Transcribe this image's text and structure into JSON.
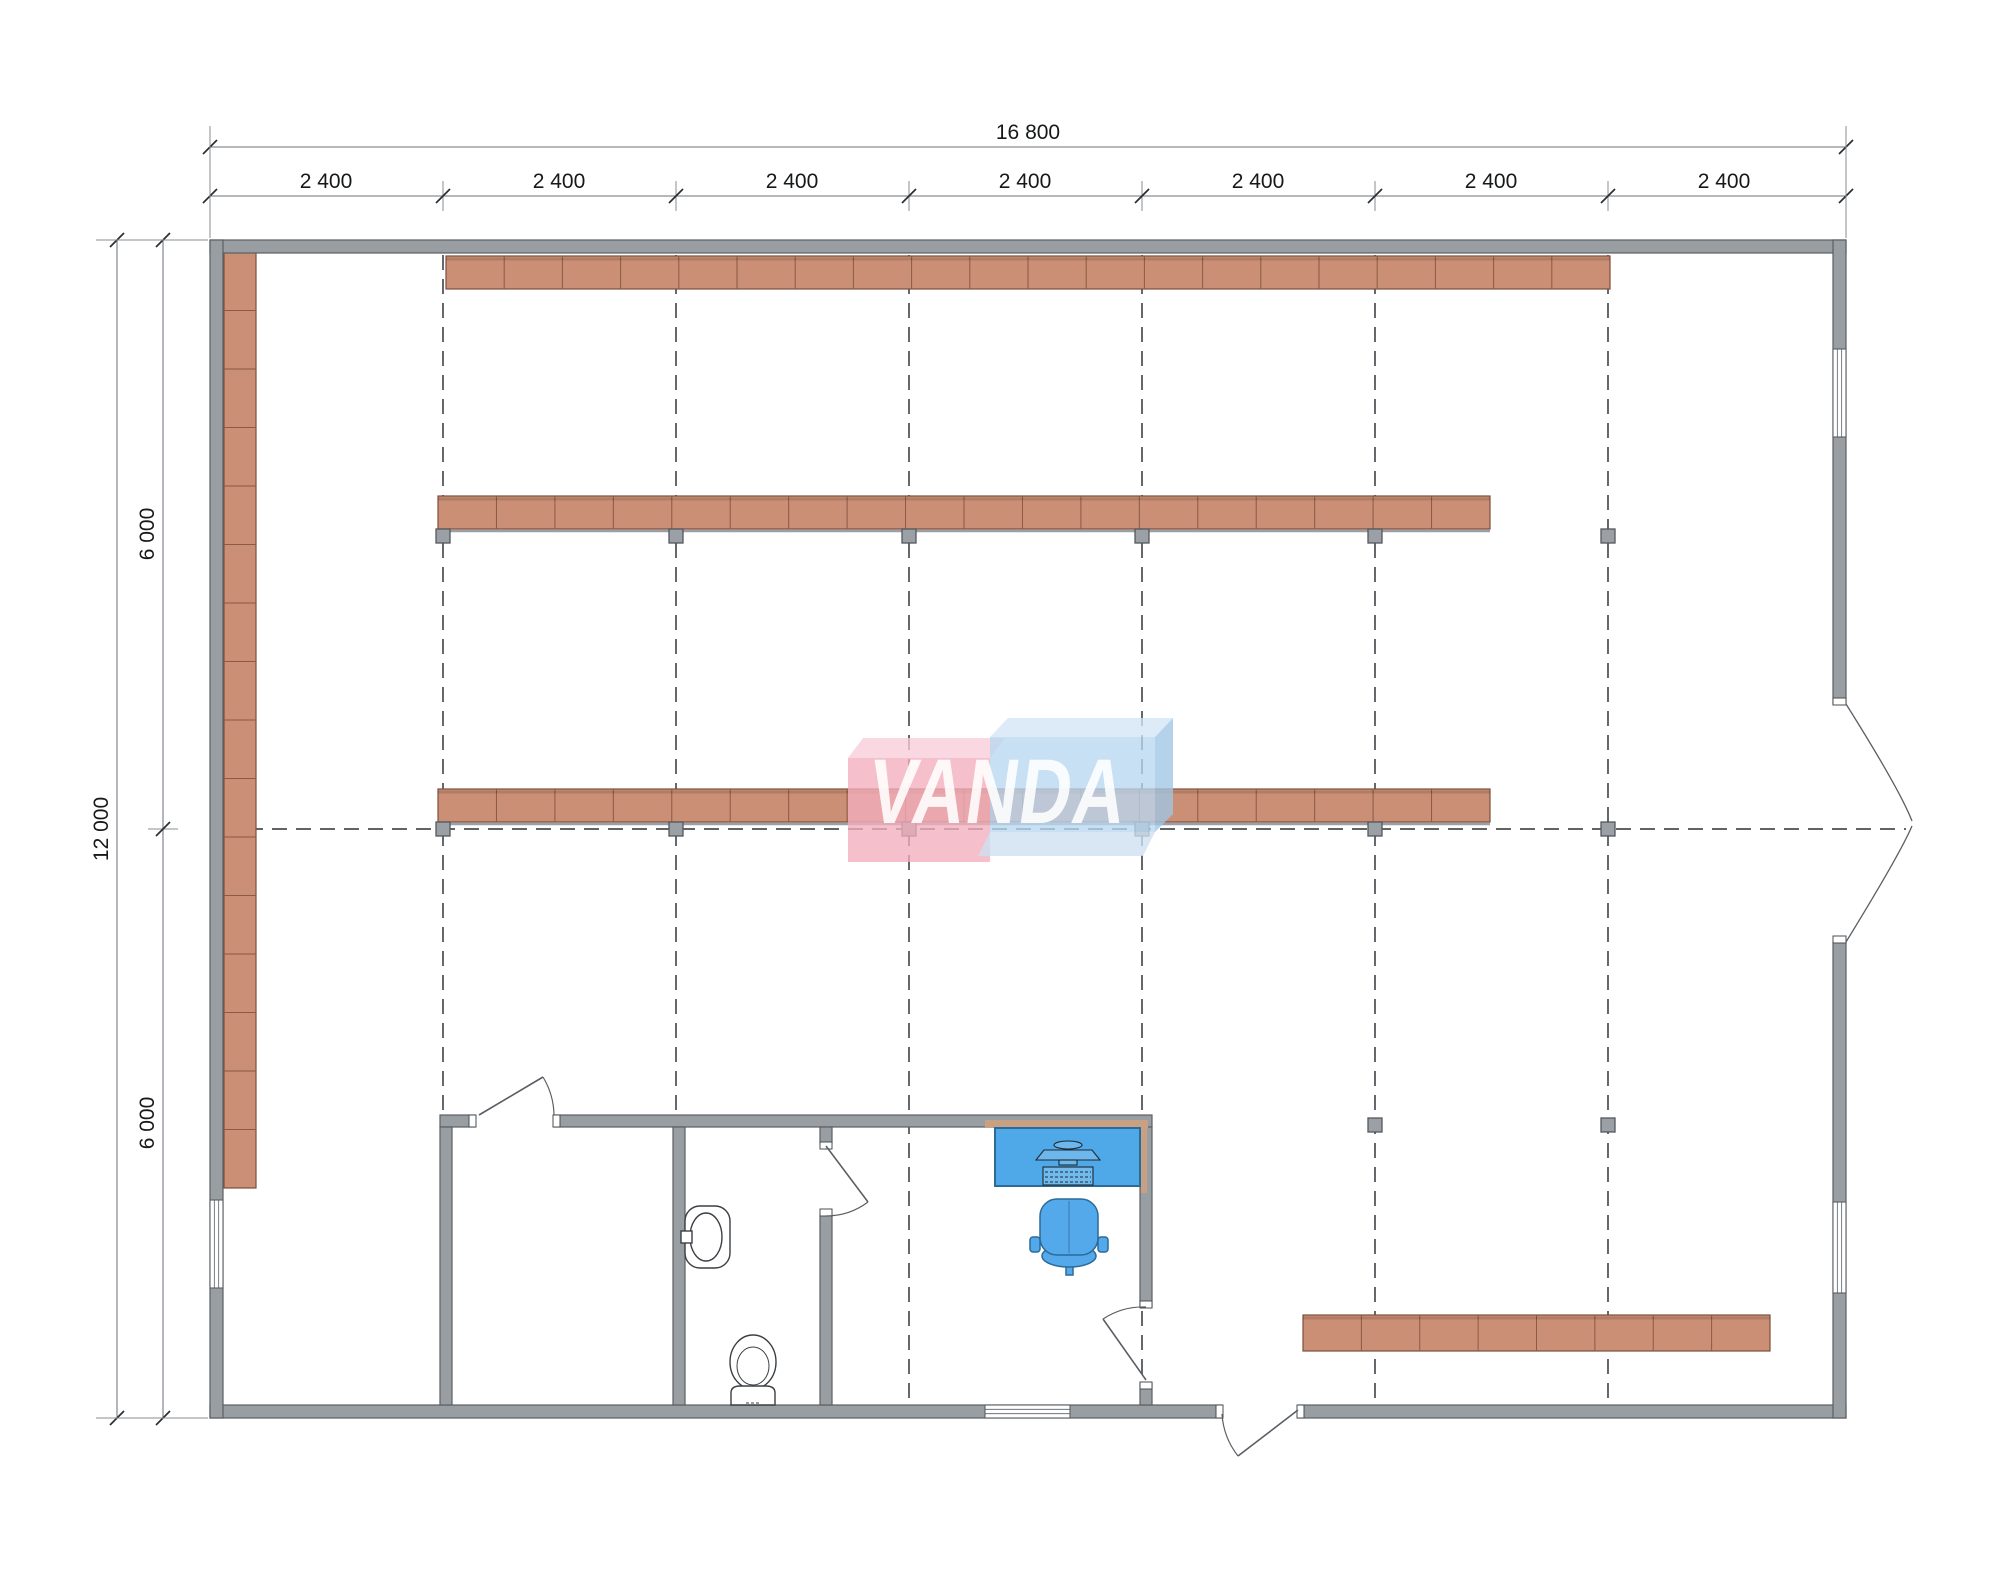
{
  "drawing": {
    "type": "retail-floor-plan",
    "logo_text": "VANDA",
    "dimensions": {
      "total_width": "16 800",
      "top_segments": [
        "2 400",
        "2 400",
        "2 400",
        "2 400",
        "2 400",
        "2 400",
        "2 400"
      ],
      "total_height": "12 000",
      "left_segments": [
        "6 000",
        "6 000"
      ]
    },
    "colors": {
      "wall_fill": "#999ea3",
      "wall_stroke": "#5a5f64",
      "shelf_fill": "#cb8f75",
      "shelf_stroke": "#7c4f3c",
      "shelf_divider": "#8a5a44",
      "marker_fill": "#9aa0a6",
      "marker_stroke": "#54585c",
      "desk_fill": "#4fa8e8",
      "chair_fill": "#54a9ea",
      "furniture_stroke": "#2a6b97",
      "fixture_stroke": "#3a3f44",
      "grid_color": "#4a4e52",
      "dim_line_color": "#8a8f94",
      "tick_color": "#2a2d30",
      "counter_tan": "#c8a184",
      "logo_pink": "#f2aebc",
      "logo_pink_lid": "#f8cdd8",
      "logo_blue": "#b9d7ef",
      "logo_blue_lid": "#d3e6f6",
      "logo_blue_side": "#9fc6e4",
      "logo_letter": "#ffffff"
    },
    "geometry": {
      "grid": {
        "verticals": [
          443,
          676,
          909,
          1142,
          1375,
          1608
        ],
        "v_y1": 255,
        "v_y2": 1405,
        "horizontal": {
          "y": 829,
          "x1": 224,
          "x2": 1906
        }
      },
      "walls": [
        {
          "x": 210,
          "y": 240,
          "w": 1636,
          "h": 13,
          "name": "wall-top"
        },
        {
          "x": 210,
          "y": 1405,
          "w": 1012,
          "h": 13,
          "name": "wall-bottom-left"
        },
        {
          "x": 1298,
          "y": 1405,
          "w": 548,
          "h": 13,
          "name": "wall-bottom-right"
        },
        {
          "x": 210,
          "y": 240,
          "w": 13,
          "h": 1178,
          "name": "wall-left"
        },
        {
          "x": 1833,
          "y": 240,
          "w": 13,
          "h": 464,
          "name": "wall-right-upper"
        },
        {
          "x": 1833,
          "y": 942,
          "w": 13,
          "h": 476,
          "name": "wall-right-lower"
        },
        {
          "x": 440,
          "y": 1115,
          "w": 35,
          "h": 12,
          "name": "rooms-top-wall-a"
        },
        {
          "x": 554,
          "y": 1115,
          "w": 598,
          "h": 12,
          "name": "rooms-top-wall-b"
        },
        {
          "x": 440,
          "y": 1127,
          "w": 12,
          "h": 278,
          "name": "rooms-left-wall"
        },
        {
          "x": 673,
          "y": 1127,
          "w": 12,
          "h": 278,
          "name": "bathroom-left-wall"
        },
        {
          "x": 820,
          "y": 1127,
          "w": 12,
          "h": 16,
          "name": "bathroom-right-stub"
        },
        {
          "x": 820,
          "y": 1215,
          "w": 12,
          "h": 190,
          "name": "bathroom-right-wall"
        },
        {
          "x": 1140,
          "y": 1127,
          "w": 12,
          "h": 180,
          "name": "office-right-wall-upper"
        },
        {
          "x": 1140,
          "y": 1383,
          "w": 12,
          "h": 22,
          "name": "office-right-wall-lower"
        }
      ],
      "shelves": [
        {
          "x": 224,
          "y": 252,
          "w": 32,
          "h": 936,
          "segs": 16,
          "dir": "v",
          "name": "shelf-row-left"
        },
        {
          "x": 446,
          "y": 256,
          "w": 1164,
          "h": 33,
          "segs": 20,
          "dir": "h",
          "name": "shelf-row-1"
        },
        {
          "x": 438,
          "y": 496,
          "w": 1052,
          "h": 33,
          "segs": 18,
          "dir": "h",
          "base": true,
          "name": "shelf-row-2"
        },
        {
          "x": 438,
          "y": 789,
          "w": 1052,
          "h": 33,
          "segs": 18,
          "dir": "h",
          "base": true,
          "name": "shelf-row-3"
        },
        {
          "x": 1303,
          "y": 1315,
          "w": 467,
          "h": 36,
          "segs": 8,
          "dir": "h",
          "name": "shelf-row-bottom"
        }
      ],
      "markers": [
        {
          "x": 443,
          "y": 529
        },
        {
          "x": 676,
          "y": 529
        },
        {
          "x": 909,
          "y": 529
        },
        {
          "x": 1142,
          "y": 529
        },
        {
          "x": 1375,
          "y": 529
        },
        {
          "x": 1608,
          "y": 529
        },
        {
          "x": 443,
          "y": 822
        },
        {
          "x": 676,
          "y": 822
        },
        {
          "x": 909,
          "y": 822
        },
        {
          "x": 1142,
          "y": 822
        },
        {
          "x": 1375,
          "y": 822
        },
        {
          "x": 1608,
          "y": 822
        },
        {
          "x": 1375,
          "y": 1118
        },
        {
          "x": 1608,
          "y": 1118
        }
      ],
      "windows": [
        {
          "x": 210,
          "y": 1200,
          "w": 13,
          "h": 88,
          "o": "v",
          "name": "window-left-wall"
        },
        {
          "x": 1833,
          "y": 349,
          "w": 13,
          "h": 88,
          "o": "v",
          "name": "window-right-upper"
        },
        {
          "x": 1833,
          "y": 1202,
          "w": 13,
          "h": 91,
          "o": "v",
          "name": "window-right-lower"
        },
        {
          "x": 985,
          "y": 1405,
          "w": 85,
          "h": 13,
          "o": "h",
          "name": "window-bottom-wall"
        }
      ],
      "jambs": [
        {
          "x": 469,
          "y": 1115,
          "w": 7,
          "h": 12
        },
        {
          "x": 553,
          "y": 1115,
          "w": 7,
          "h": 12
        },
        {
          "x": 820,
          "y": 1142,
          "w": 12,
          "h": 7
        },
        {
          "x": 820,
          "y": 1209,
          "w": 12,
          "h": 7
        },
        {
          "x": 1140,
          "y": 1301,
          "w": 12,
          "h": 7
        },
        {
          "x": 1140,
          "y": 1382,
          "w": 12,
          "h": 7
        },
        {
          "x": 1216,
          "y": 1405,
          "w": 7,
          "h": 13
        },
        {
          "x": 1297,
          "y": 1405,
          "w": 7,
          "h": 13
        },
        {
          "x": 1833,
          "y": 698,
          "w": 13,
          "h": 7
        },
        {
          "x": 1833,
          "y": 936,
          "w": 13,
          "h": 7
        }
      ],
      "dim_lines": {
        "total_top": {
          "y": 147,
          "x1": 210,
          "x2": 1846,
          "ticks": [
            210,
            1846
          ]
        },
        "segments_top": {
          "y": 196,
          "x1": 210,
          "x2": 1846,
          "ticks": [
            210,
            443,
            676,
            909,
            1142,
            1375,
            1608,
            1846
          ]
        },
        "total_left": {
          "x": 117,
          "y1": 240,
          "y2": 1418,
          "ticks": [
            240,
            1418
          ]
        },
        "segments_left": {
          "x": 163,
          "y1": 240,
          "y2": 1418,
          "ticks": [
            240,
            829,
            1418
          ]
        }
      }
    }
  }
}
